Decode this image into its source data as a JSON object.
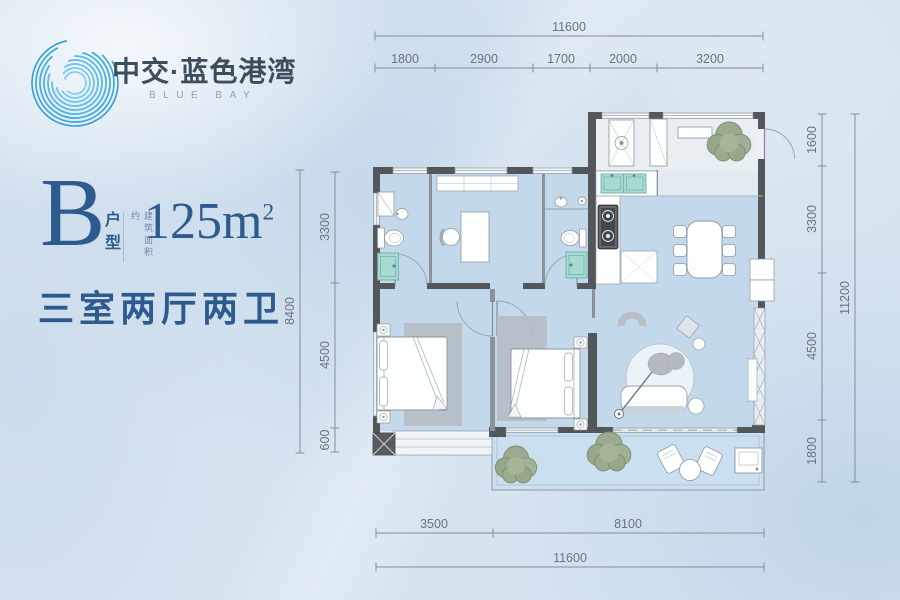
{
  "brand": {
    "name": "中交·蓝色港湾",
    "sub": "BLUE BAY"
  },
  "unit": {
    "letter": "B",
    "letter_suffix": "户型",
    "area_prefix": "建筑面积约",
    "area": "125m",
    "area_exp": "2",
    "layout": "三室两厅两卫"
  },
  "dimensions": {
    "top": {
      "total": "11600",
      "segments": [
        "1800",
        "2900",
        "1700",
        "2000",
        "3200"
      ]
    },
    "bottom": {
      "total": "11600",
      "segments": [
        "3500",
        "8100"
      ]
    },
    "left": {
      "total": "8400",
      "segments": [
        "3300",
        "4500",
        "600"
      ]
    },
    "right": {
      "total": "11200",
      "segments": [
        "1600",
        "3300",
        "4500",
        "1800"
      ]
    }
  },
  "colors": {
    "wall": "#53575b",
    "floor": "#c3d8ea",
    "accent_blue": "#2e5b8d",
    "logo_blue": "#35a5de",
    "fixture_teal": "#a6dad2"
  }
}
